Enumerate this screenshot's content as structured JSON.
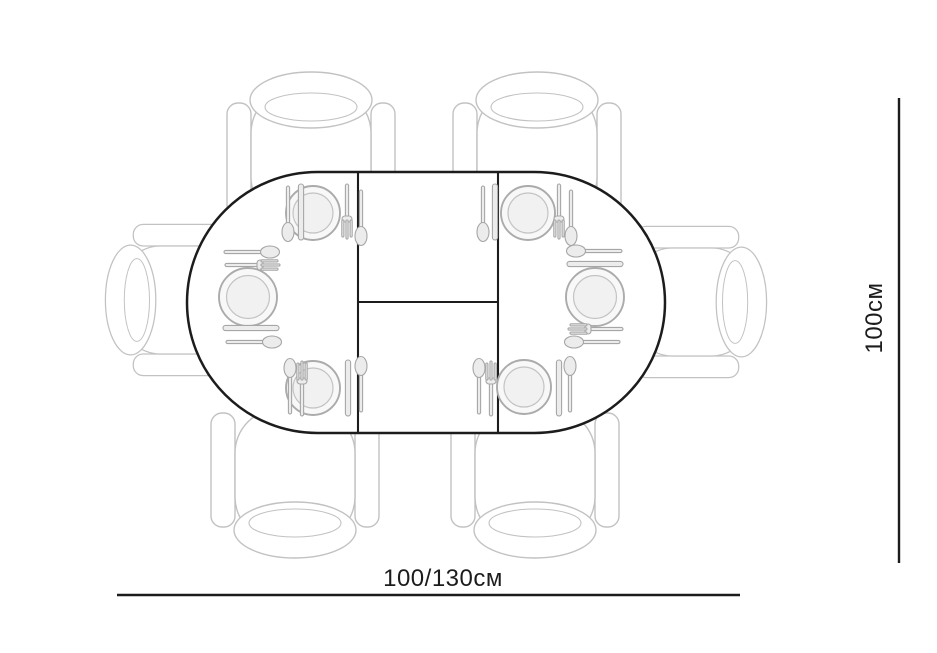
{
  "diagram": {
    "title": "Extendable oval dining table - top view plan",
    "table_shape": "oval (stadium) table with rectangular center extension leaf",
    "seats": 6,
    "chairs": 6,
    "place_settings": 6,
    "chair_positions": [
      "top-left",
      "top-right",
      "left",
      "right",
      "bottom-left",
      "bottom-right"
    ],
    "place_setting_positions": [
      "top-left",
      "middle-left",
      "bottom-left",
      "top-right",
      "middle-right",
      "bottom-right"
    ],
    "place_setting_items": [
      "plate",
      "spoon",
      "knife",
      "fork"
    ]
  },
  "dimensions": {
    "width_label": "100/130см",
    "depth_label": "100см"
  },
  "colors": {
    "background": "#ffffff",
    "table_outline": "#1c1c1c",
    "dimension_line": "#1c1c1c",
    "chair_outline": "#c2c2c2",
    "tableware_outline": "#a6a6a6",
    "label_text": "#1c1c1c"
  }
}
